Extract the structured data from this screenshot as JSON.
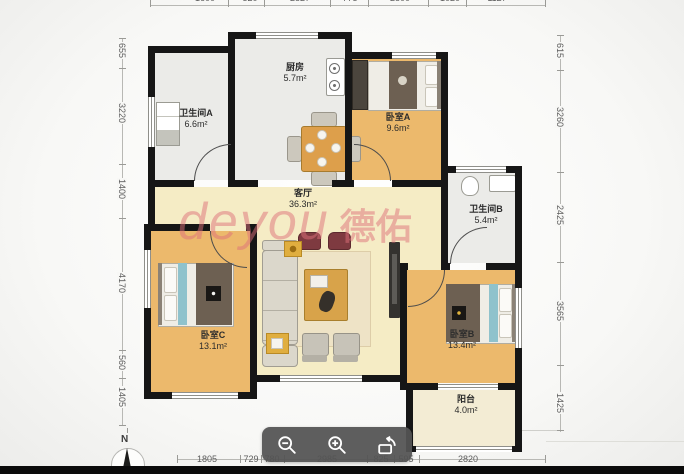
{
  "viewer": {
    "compass_label": "N",
    "watermark": {
      "latin": "deyou",
      "cjk": "德佑"
    },
    "toolbar": {
      "icons": [
        "magnifier-minus",
        "magnifier-plus",
        "rotate-frame"
      ]
    }
  },
  "rooms": [
    {
      "name": "卫生间A",
      "area": "6.6m²"
    },
    {
      "name": "厨房",
      "area": "5.7m²"
    },
    {
      "name": "卧室A",
      "area": "9.6m²"
    },
    {
      "name": "客厅",
      "area": "36.3m²"
    },
    {
      "name": "卫生间B",
      "area": "5.4m²"
    },
    {
      "name": "卧室C",
      "area": "13.1m²"
    },
    {
      "name": "卧室B",
      "area": "13.4m²"
    },
    {
      "name": "阳台",
      "area": "4.0m²"
    }
  ],
  "rulers": {
    "left": [
      "655",
      "3220",
      "1400",
      "4170",
      "560",
      "1405"
    ],
    "right": [
      "615",
      "3260",
      "2425",
      "3565",
      "1425"
    ],
    "bottom": [
      "1805",
      "729",
      "780",
      "2985",
      "825",
      "595",
      "2820"
    ],
    "top_clipped": [
      "1600",
      "520",
      "2827",
      "775",
      "2800",
      "1020",
      "1127"
    ]
  },
  "colors": {
    "wall": "#161616",
    "bedroom_floor": "#ecb96c",
    "living_floor": "#f5ecc5",
    "wet_floor": "#ebebe8",
    "balcony_floor": "#f3ecd4",
    "watermark": "#de707a",
    "toolbar": "#545454"
  }
}
